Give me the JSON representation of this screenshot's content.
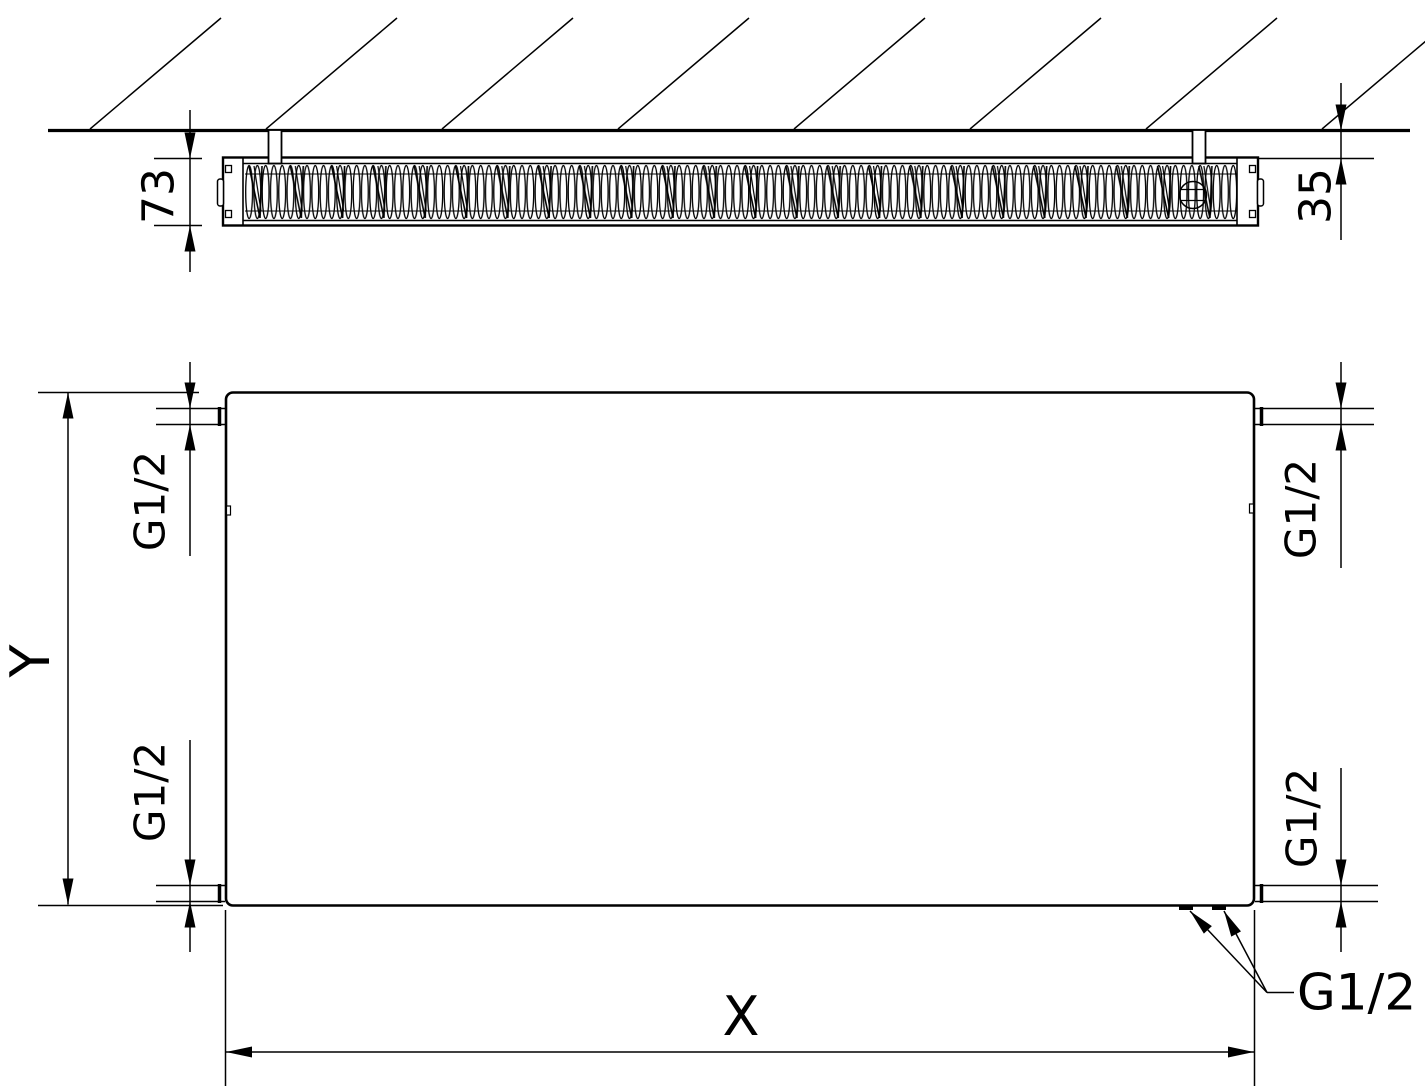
{
  "drawing": {
    "top_view": {
      "radiator_depth": "73",
      "wall_clearance": "35"
    },
    "front_view": {
      "height_label": "Y",
      "width_label": "X",
      "thread_top_left": "G1/2",
      "thread_top_right": "G1/2",
      "thread_bottom_left": "G1/2",
      "thread_bottom_right": "G1/2",
      "thread_bottom_connections": "G1/2"
    },
    "colors": {
      "line": "#000000",
      "background": "#ffffff"
    }
  }
}
